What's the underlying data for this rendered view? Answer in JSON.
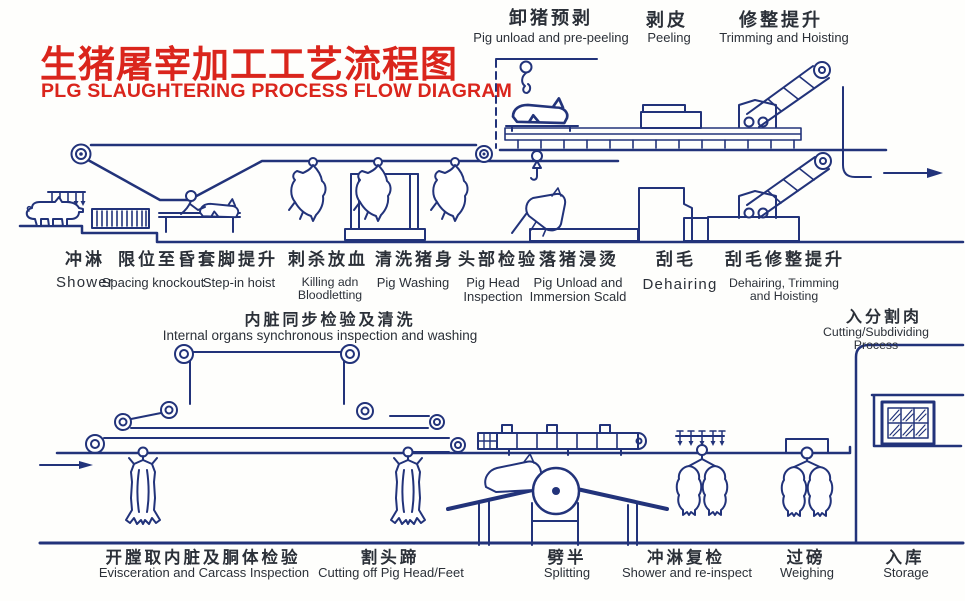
{
  "title": {
    "zh": "生猪屠宰加工工艺流程图",
    "en": "PLG SLAUGHTERING PROCESS FLOW DIAGRAM"
  },
  "colors": {
    "ink": "#22337a",
    "title_red": "#da251c",
    "label_text": "#2b3038",
    "background": "#fefefc"
  },
  "top_row": [
    {
      "zh": "卸猪预剥",
      "en": "Pig unload and pre-peeling"
    },
    {
      "zh": "剥皮",
      "en": "Peeling"
    },
    {
      "zh": "修整提升",
      "en": "Trimming and Hoisting"
    }
  ],
  "mid_row": [
    {
      "zh": "冲淋",
      "en": "Shower"
    },
    {
      "zh": "限位至昏",
      "en": "Spacing knockout"
    },
    {
      "zh": "套脚提升",
      "en": "Step-in hoist"
    },
    {
      "zh": "刺杀放血",
      "en": "Killing adn\nBloodletting"
    },
    {
      "zh": "清洗猪身",
      "en": "Pig Washing"
    },
    {
      "zh": "头部检验",
      "en": "Pig Head\nInspection"
    },
    {
      "zh": "落猪浸烫",
      "en": "Pig Unload and\nImmersion Scald"
    },
    {
      "zh": "刮毛",
      "en": "Dehairing"
    },
    {
      "zh": "刮毛修整提升",
      "en": "Dehairing, Trimming\nand Hoisting"
    }
  ],
  "mid_band": [
    {
      "zh": "内脏同步检验及清洗",
      "en": "Internal organs synchronous inspection and washing"
    },
    {
      "zh": "入分割肉",
      "en": "Cutting/Subdividing Process"
    }
  ],
  "bottom_row": [
    {
      "zh": "开膛取内脏及胴体检验",
      "en": "Evisceration and Carcass Inspection"
    },
    {
      "zh": "割头蹄",
      "en": "Cutting off Pig Head/Feet"
    },
    {
      "zh": "劈半",
      "en": "Splitting"
    },
    {
      "zh": "冲淋复检",
      "en": "Shower and re-inspect"
    },
    {
      "zh": "过磅",
      "en": "Weighing"
    },
    {
      "zh": "入库",
      "en": "Storage"
    }
  ]
}
